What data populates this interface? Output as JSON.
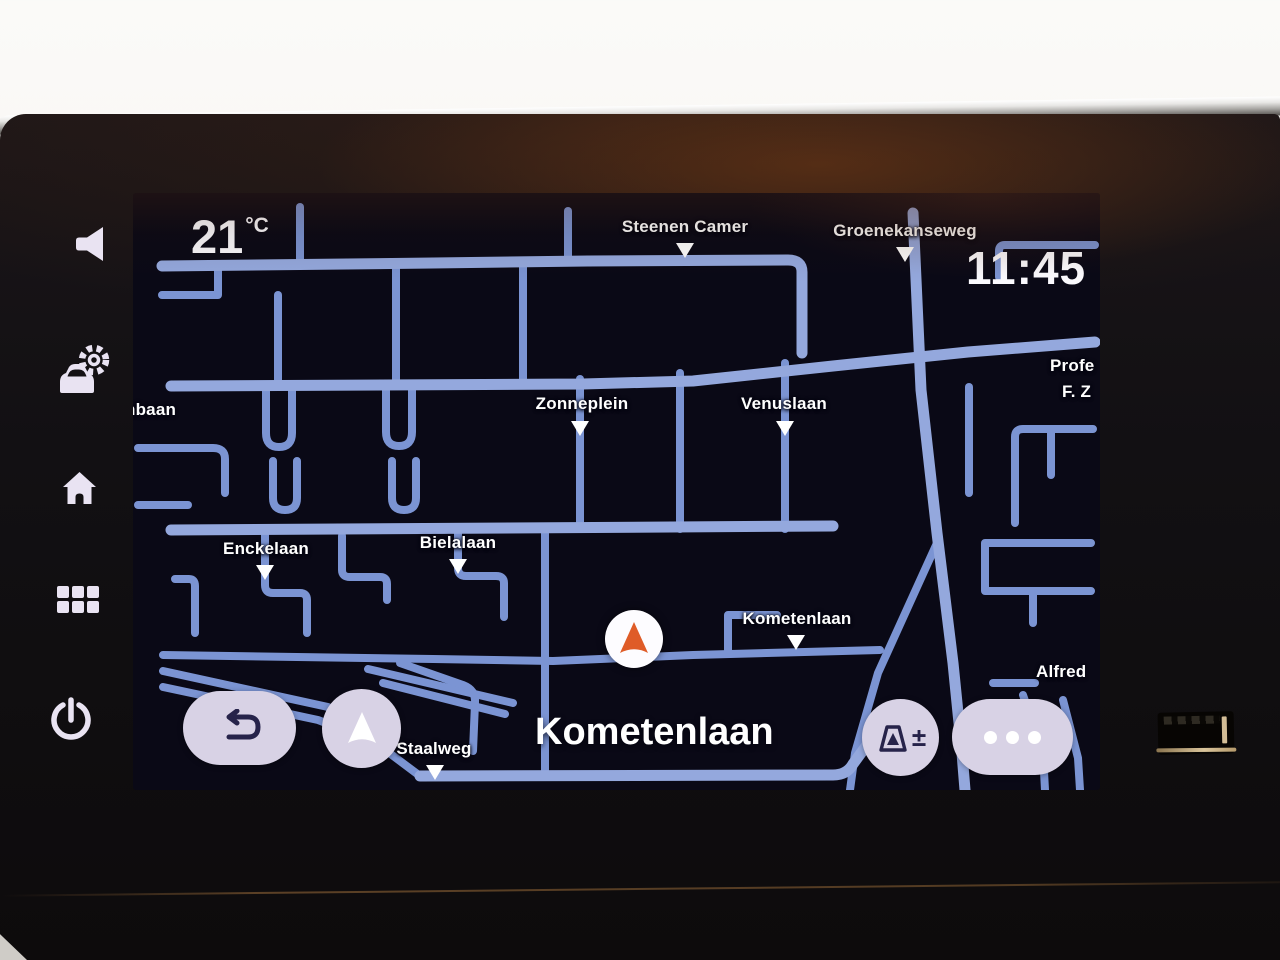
{
  "statusbar": {
    "temperature": "21",
    "temperature_unit": "°C",
    "time": "11:45"
  },
  "map": {
    "current_street": "Kometenlaan",
    "labels": [
      {
        "text": "Steenen Camer"
      },
      {
        "text": "Groenekanseweg"
      },
      {
        "text": "Zonneplein"
      },
      {
        "text": "Venuslaan"
      },
      {
        "text": "nbaan"
      },
      {
        "text": "Profe"
      },
      {
        "text": "F. Z"
      },
      {
        "text": "Enckelaan"
      },
      {
        "text": "Bielalaan"
      },
      {
        "text": "Kometenlaan"
      },
      {
        "text": "Staalweg"
      },
      {
        "text": "Alfred"
      }
    ],
    "colors": {
      "road": "#7b94d3",
      "road_major": "#94a8dd",
      "screen_background": "#0a0916",
      "label_color": "#ffffff",
      "car_arrow": "#df5c28"
    }
  },
  "controls": {
    "back_button": {
      "icon": "undo-arrow"
    },
    "nav_button": {
      "icon": "navigation-arrow"
    },
    "speed_alert_button": {
      "icon": "road-sign",
      "label": "±"
    },
    "more_button": {
      "icon": "three-dots"
    }
  },
  "sidebar": {
    "items": [
      {
        "icon": "speaker"
      },
      {
        "icon": "car-settings"
      },
      {
        "icon": "home"
      },
      {
        "icon": "app-grid"
      },
      {
        "icon": "power"
      }
    ]
  },
  "hardware": {
    "usb_port": "usb-a"
  }
}
